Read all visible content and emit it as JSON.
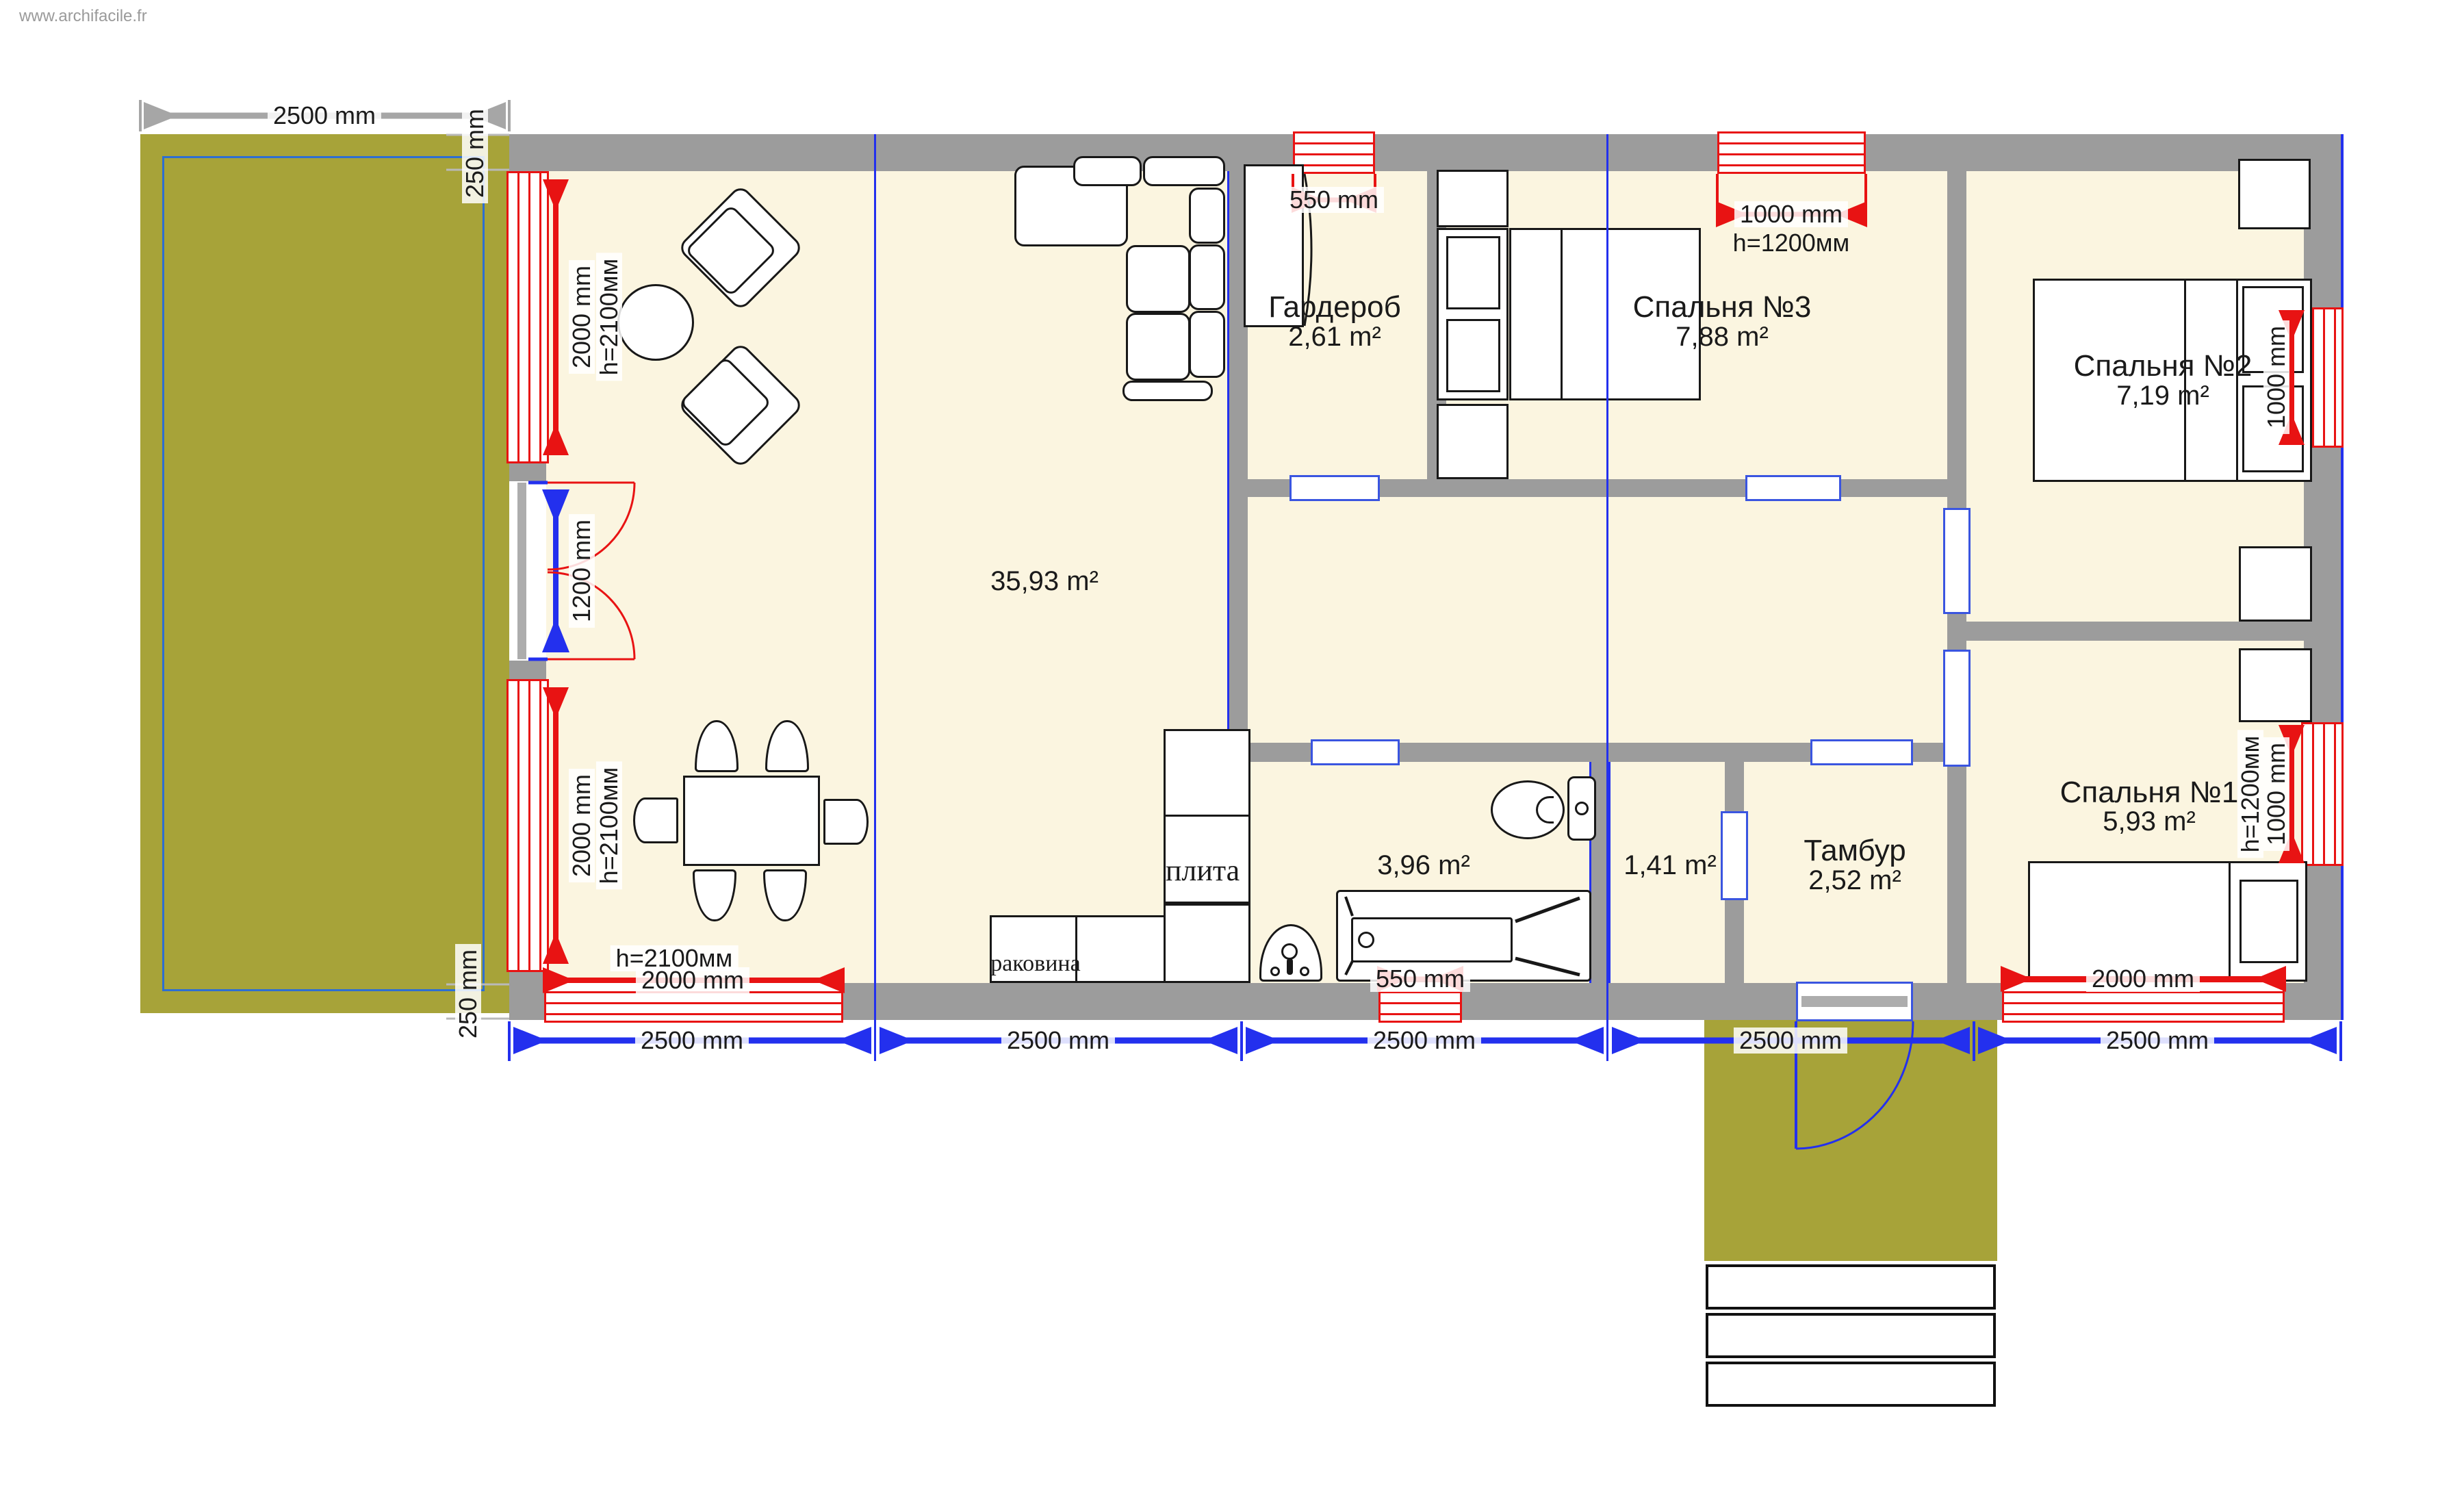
{
  "watermark": "www.archifacile.fr",
  "labels": {
    "living_area": "35,93 m²",
    "wardrobe_name": "Гардероб",
    "wardrobe_area": "2,61 m²",
    "bedroom3_name": "Спальня №3",
    "bedroom3_area": "7,88 m²",
    "bedroom2_name": "Спальня №2",
    "bedroom2_area": "7,19 m²",
    "bedroom1_name": "Спальня №1",
    "bedroom1_area": "5,93 m²",
    "bathroom_area": "3,96 m²",
    "wc_area": "1,41 m²",
    "vestibule_name": "Тамбур",
    "vestibule_area": "2,52 m²",
    "stove": "плита",
    "sink": "раковина"
  },
  "dimensions": {
    "terrace_width": "2500 mm",
    "wall_thickness_top": "250 mm",
    "wall_thickness_bottom": "250 mm",
    "window_left_1": "2000 mm",
    "window_left_1_h": "h=2100мм",
    "door_left": "1200 mm",
    "window_left_2": "2000 mm",
    "window_left_2_h": "h=2100мм",
    "window_top_wardrobe": "550 mm",
    "window_top_bedroom3": "1000 mm",
    "window_top_bedroom3_h": "h=1200мм",
    "window_right_bedroom2": "1000 mm",
    "window_right_bedroom1": "1000 mm",
    "window_right_bedroom1_h": "h=1200мм",
    "window_bottom_living": "2000 mm",
    "window_bottom_living_h": "h=2100мм",
    "window_bottom_bath": "550 mm",
    "window_bottom_bedroom1": "2000 mm",
    "grid": [
      "2500 mm",
      "2500 mm",
      "2500 mm",
      "2500 mm",
      "2500 mm"
    ]
  },
  "colors": {
    "floor": "#fbf5e0",
    "wall": "#9c9c9c",
    "terrace": "#a7a339",
    "red": "#e81313",
    "blue": "#2330ee",
    "gray_dim": "#a6a6a6"
  }
}
